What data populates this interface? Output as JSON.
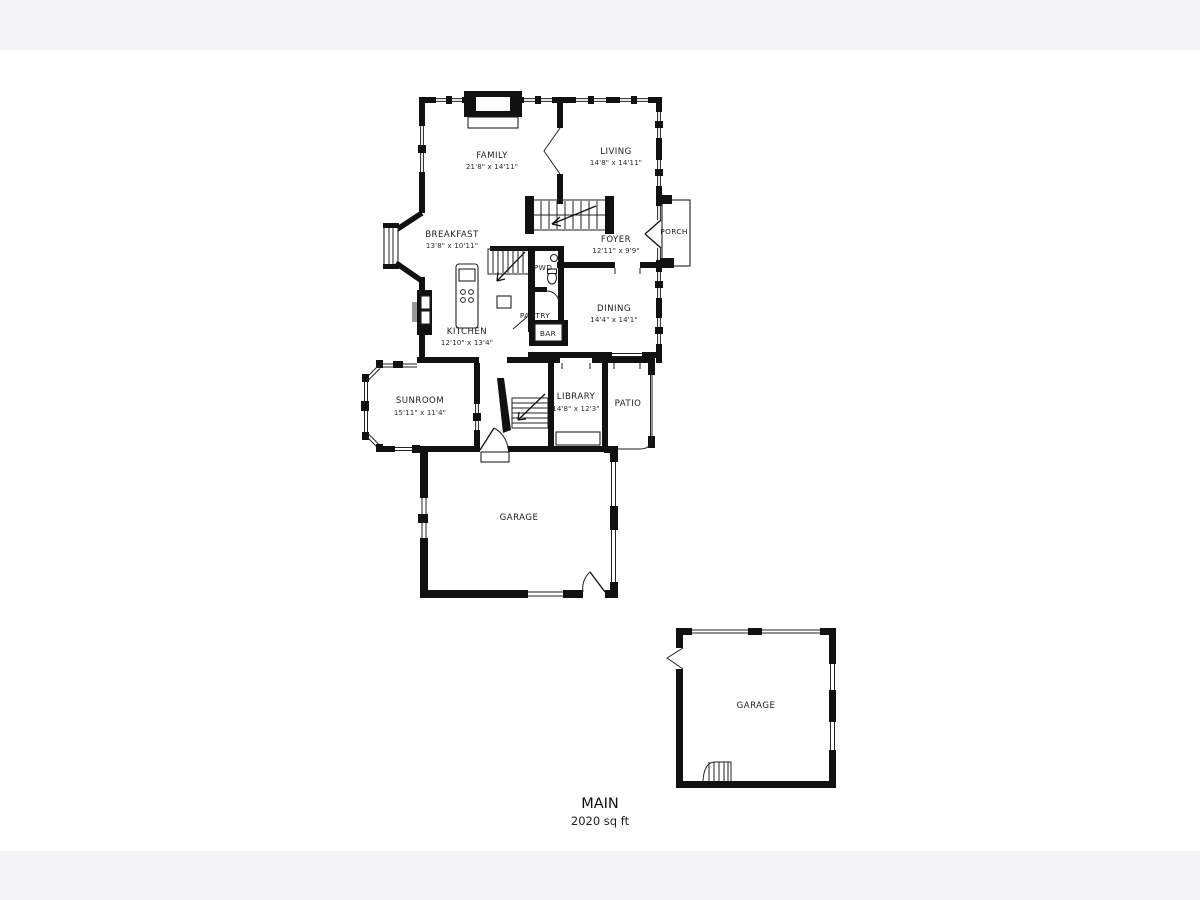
{
  "page": {
    "background": "#ffffff",
    "band_color": "#f5f4f6",
    "wall_color": "#111111",
    "text_color": "#1c1c1c"
  },
  "plan": {
    "floor": {
      "label": "MAIN",
      "area": "2020 sq ft"
    },
    "rooms": {
      "family": {
        "name": "FAMILY",
        "dims": "21'8\" x 14'11\""
      },
      "living": {
        "name": "LIVING",
        "dims": "14'8\" x 14'11\""
      },
      "breakfast": {
        "name": "BREAKFAST",
        "dims": "13'8\" x 10'11\""
      },
      "foyer": {
        "name": "FOYER",
        "dims": "12'11\" x 9'9\""
      },
      "porch": {
        "name": "PORCH"
      },
      "pwd": {
        "name": "PWD"
      },
      "kitchen": {
        "name": "KITCHEN",
        "dims": "12'10\" x 13'4\""
      },
      "pantry": {
        "name": "PANTRY"
      },
      "bar": {
        "name": "BAR"
      },
      "dining": {
        "name": "DINING",
        "dims": "14'4\" x 14'1\""
      },
      "sunroom": {
        "name": "SUNROOM",
        "dims": "15'11\" x 11'4\""
      },
      "library": {
        "name": "LIBRARY",
        "dims": "14'8\" x 12'3\""
      },
      "patio": {
        "name": "PATIO"
      },
      "garage_attached": {
        "name": "GARAGE"
      },
      "garage_detached": {
        "name": "GARAGE"
      }
    }
  }
}
